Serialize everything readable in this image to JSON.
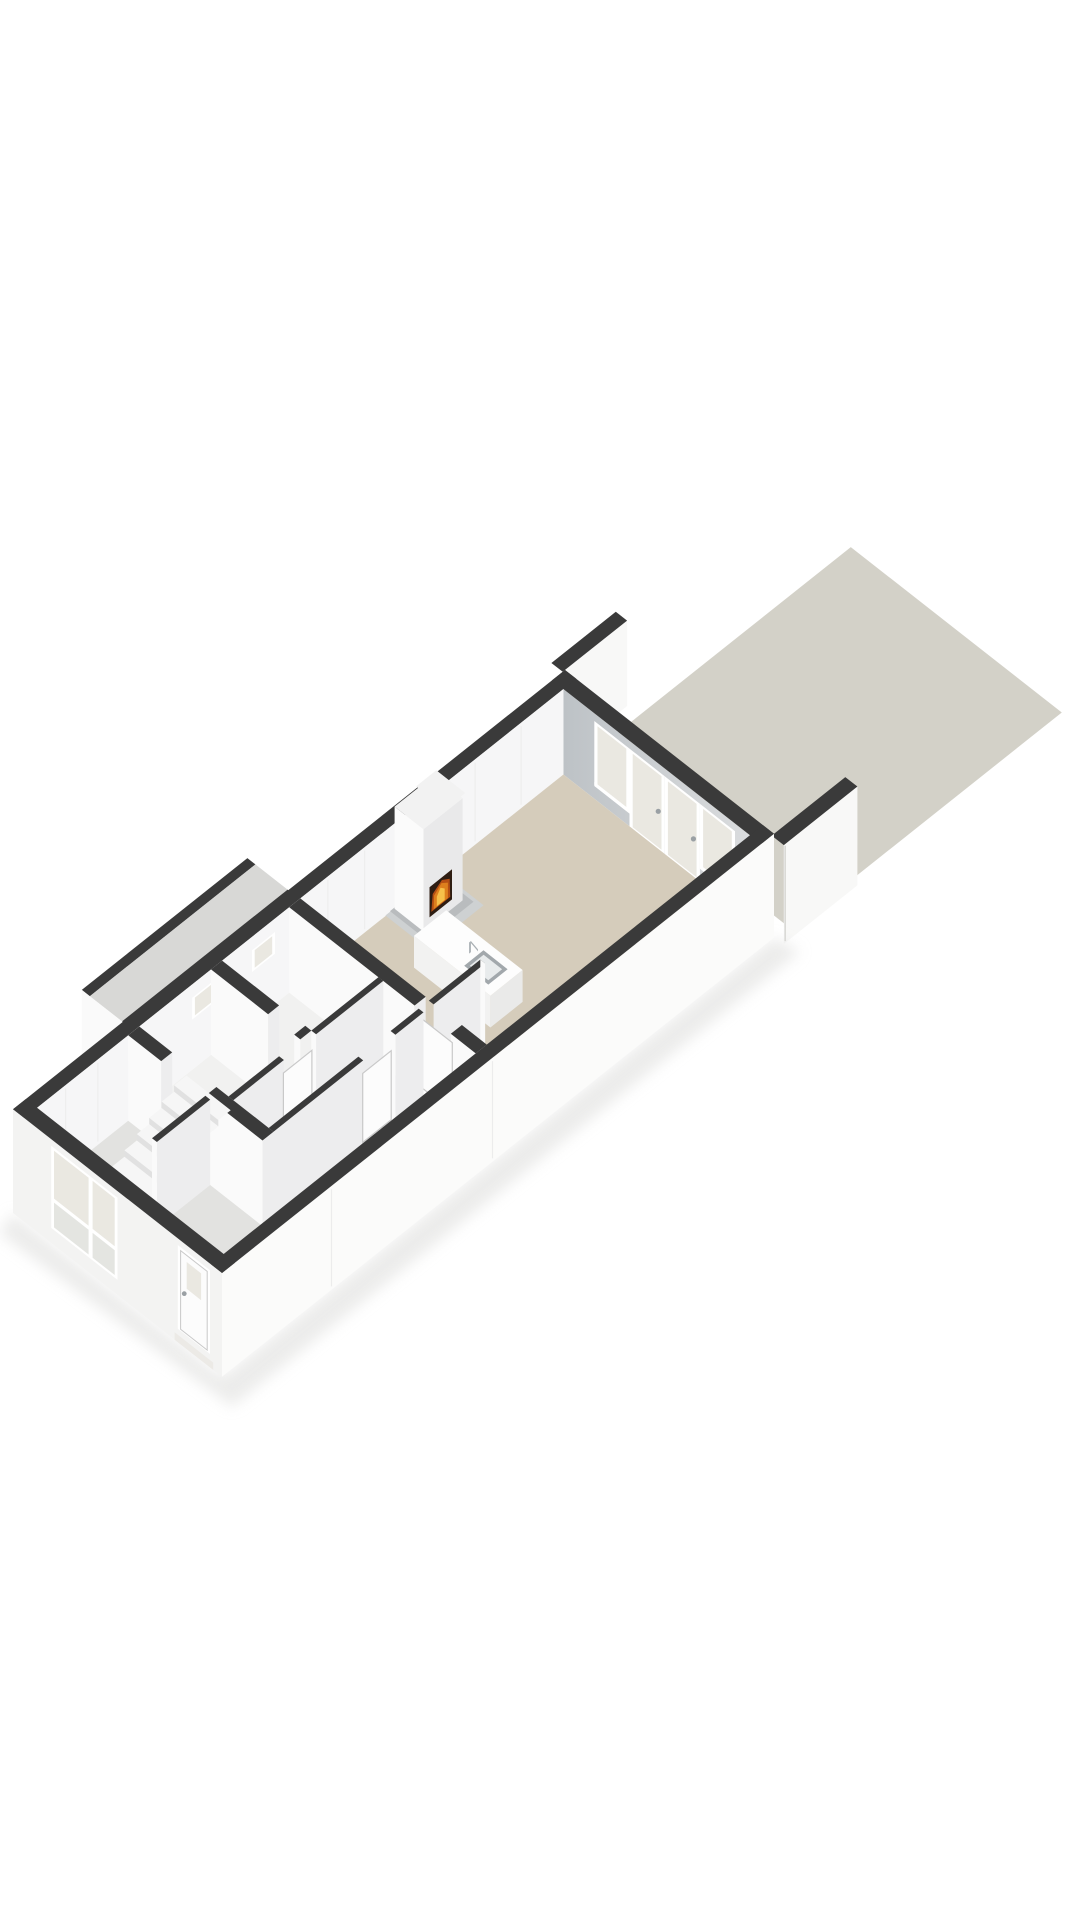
{
  "view": {
    "description": "3D isometric rendering of a ground-floor floor plan with rear garden terrace",
    "background": "#ffffff"
  },
  "colors": {
    "bg": "#ffffff",
    "wallTop": "#3a3a3a",
    "extWall": "#fbfbfa",
    "extWallShade": "#f3f3f2",
    "gardenWall": "#f8f8f7",
    "faceSW": "#fafafa",
    "faceSE": "#ededee",
    "innerLeft": "#f6f6f7",
    "rearWallA": "#bdc2c6",
    "rearWallB": "#dadcde",
    "livingFloor": "#d5ccbb",
    "hallFloor": "#e2e2e0",
    "roomFloor": "#f1f1f0",
    "terrace": "#d3d1c8",
    "annexTop": "#d8d8d6",
    "glass": "#eae8e1",
    "glassLow": "#e4e5e1",
    "frame": "#ffffff",
    "frameShade": "#d8d8d8",
    "stairTread": "#f6f6f6",
    "stairRiser": "#e1e1e1",
    "doorLeaf": "#fcfcfc",
    "doorEdge": "#c9c9c9",
    "chimney": "#fbfbfb",
    "chimneySide": "#e9e9ea",
    "chimneyCap": "#f2f2f2",
    "hearth": "#b9bcbe",
    "hearthLight": "#ced1d2",
    "firebox": "#2e1d12",
    "fireOrange": "#dd7f1d",
    "fireYellow": "#f6c04a",
    "fireGlow": "#b54f14",
    "sinkRim": "#a2a8ac",
    "sinkBasin": "#e8ebec",
    "faucet": "#aab0b4",
    "counterTop": "#fdfdfd",
    "counterFront": "#f2f2f1",
    "counterSide": "#eaeae9",
    "shadow": "#dddddb",
    "seam": "#ececec",
    "handle": "#9aa0a4"
  },
  "scene": {
    "elements": [
      "terrace-patio",
      "garden-wall-left",
      "garden-wall-right",
      "rear-wall-glazing",
      "fireplace-with-fire",
      "kitchen-island-with-sink-and-faucet",
      "interior-walls-with-doors",
      "small-high-windows-left-wall",
      "side-annex",
      "staircase",
      "entrance-hall",
      "front-window",
      "front-door-with-step"
    ]
  }
}
